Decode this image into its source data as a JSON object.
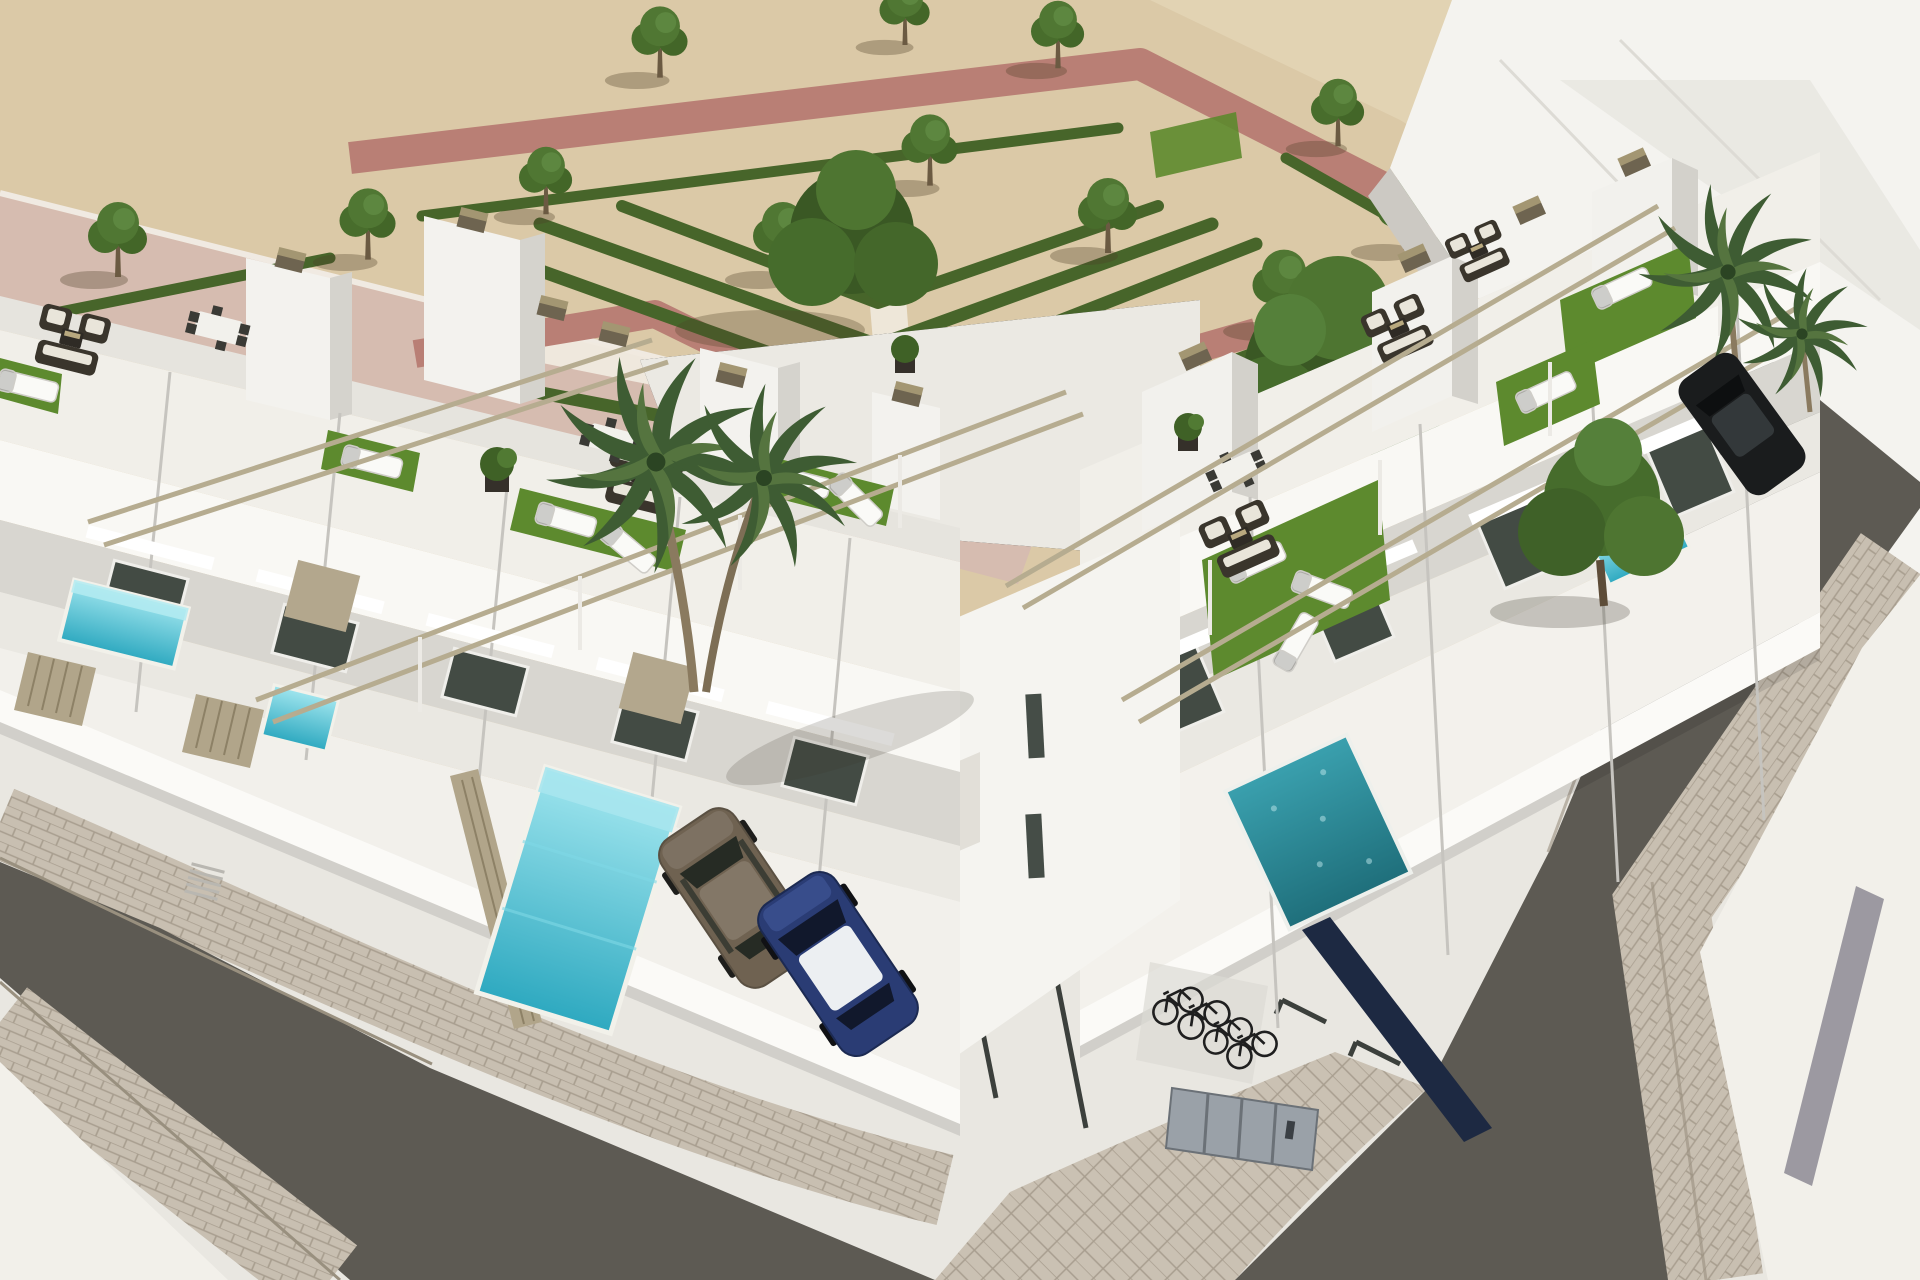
{
  "meta": {
    "kind": "3d-architectural-render",
    "view": "high-angle aerial",
    "description": "Photorealistic render of a modern white townhouse development on a street corner: rooftop terraces with artificial turf, sun loungers and pergolas, private plunge pools behind slatted fences, a landscaped park with chevron hedges and trees, asphalt streets with cobblestone sidewalks, parked cars and a bicycle nook.",
    "image_width": 1920,
    "image_height": 1280
  },
  "objects": {
    "park": {
      "small_trees": 12,
      "large_trees": 2,
      "hedges": "zigzag chevron rows",
      "walkways": "pink paths and white gravel walks"
    },
    "buildings": {
      "left_row_units": 6,
      "right_row_units": 5,
      "background_building": 1,
      "existing_flat_roof_building": 1
    },
    "terraces": {
      "turf_patches": 8,
      "sun_loungers": 11,
      "wicker_lounge_sets": 5,
      "dining_sets": 3,
      "pergola_beam_pairs": 4,
      "planters": 3
    },
    "pools": {
      "turquoise_plunge_pools": 5,
      "teal_pool": 1
    },
    "vehicles": {
      "bronze_car": 1,
      "blue_car_with_white_roof": 1,
      "black_car": 1
    },
    "bicycles": 4,
    "streets": {
      "asphalt_roads": 2,
      "cobblestone_sidewalks": 4,
      "marked_parking_spaces": 4,
      "utility_cabinet": 1,
      "garage_door": 1
    }
  },
  "palette": {
    "sand": "#dbc9a7",
    "sand_light": "#ecdfc4",
    "roof_pink": "#d6bcb0",
    "roof_edge": "#f0eae2",
    "path_pink": "#b97f75",
    "walk_white": "#f0eadf",
    "hedge_green": "#47652a",
    "tree_green": "#4e7431",
    "tree_green_dark": "#3a5824",
    "tree_trunk": "#5d4c38",
    "turf_green": "#5d8a2e",
    "white_wall": "#f1efe9",
    "white_upper": "#f9f8f4",
    "white_bright": "#fbfaf7",
    "wall_shade": "#d8d6d0",
    "wall_light": "#eae8e2",
    "rear_wall": "#e6e4de",
    "parapet_line": "#c6c4bf",
    "glass_dark": "#434b44",
    "fence_beige": "#b1a58a",
    "fence_line": "#8d8166",
    "panel_tan": "#b3a78d",
    "beam_tan": "#b6ac90",
    "cap_top": "#a39672",
    "cap_side": "#6e6450",
    "pavement_white": "#e9e7e1",
    "pavement_bright": "#f2f0ea",
    "road_asphalt": "#5d5a53",
    "paver": "#c8bfb1",
    "paver_line": "#a89e8f",
    "stripe_gray": "#8d8a94",
    "marking_dark": "#3c403c",
    "pool_turquoise": "#4fc4d6",
    "pool_light": "#9fe5ee",
    "pool_teal": "#2e8fa0",
    "navy_glass": "#1d2942",
    "garage_beige": "#cfc0a5",
    "car_bronze": "#6f6251",
    "car_blue": "#2a3c74",
    "car_blue_roof": "#eceff2",
    "car_black": "#1a1c1d",
    "bike_dark": "#1f1f1f",
    "cabinet_gray": "#9aa1a8",
    "cabinet_line": "#6b7177"
  }
}
